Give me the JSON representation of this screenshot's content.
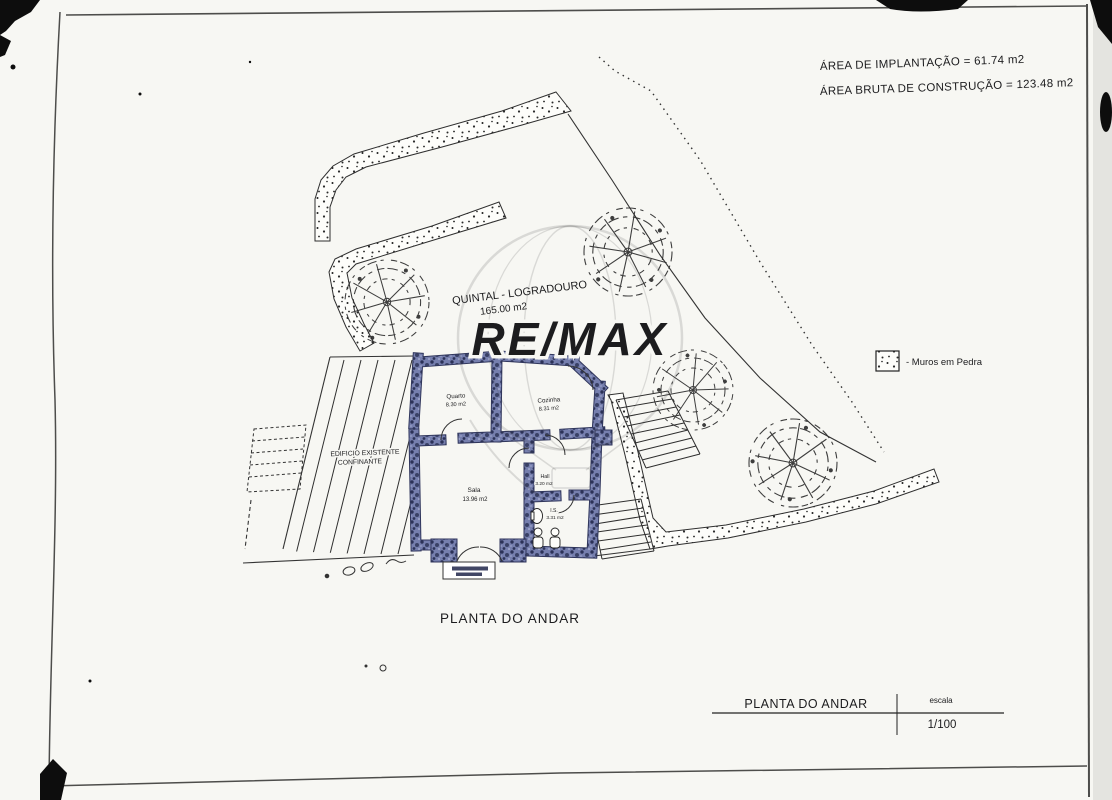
{
  "document": {
    "areas": {
      "line1": "ÁREA DE IMPLANTAÇÃO = 61.74 m2",
      "line2": "ÁREA BRUTA DE CONSTRUÇÃO = 123.48 m2"
    },
    "yard": {
      "title": "QUINTAL - LOGRADOURO",
      "area": "165.00 m2"
    },
    "legend": {
      "label": "- Muros em Pedra"
    },
    "rooms": {
      "quarto": {
        "name": "Quarto",
        "area": "8.30 m2"
      },
      "cozinha": {
        "name": "Cozinha",
        "area": "8.31 m2"
      },
      "sala": {
        "name": "Sala",
        "area": "13.96 m2"
      },
      "hall": {
        "name": "Hall",
        "area": "3.20 m2"
      },
      "is": {
        "name": "I.S.",
        "area": "3.31 m2"
      }
    },
    "existing": {
      "line1": "EDIFICIO EXISTENTE",
      "line2": "CONFINANTE"
    },
    "caption": "PLANTA DO ANDAR",
    "titleblock": {
      "title": "PLANTA DO ANDAR",
      "scale_label": "escala",
      "scale_value": "1/100"
    },
    "watermark": {
      "text": "RE/MAX"
    },
    "colors": {
      "wall": "#767fae",
      "wall_dark": "#30365c",
      "ink": "#1c1c1e",
      "paper": "#f7f7f3"
    }
  }
}
